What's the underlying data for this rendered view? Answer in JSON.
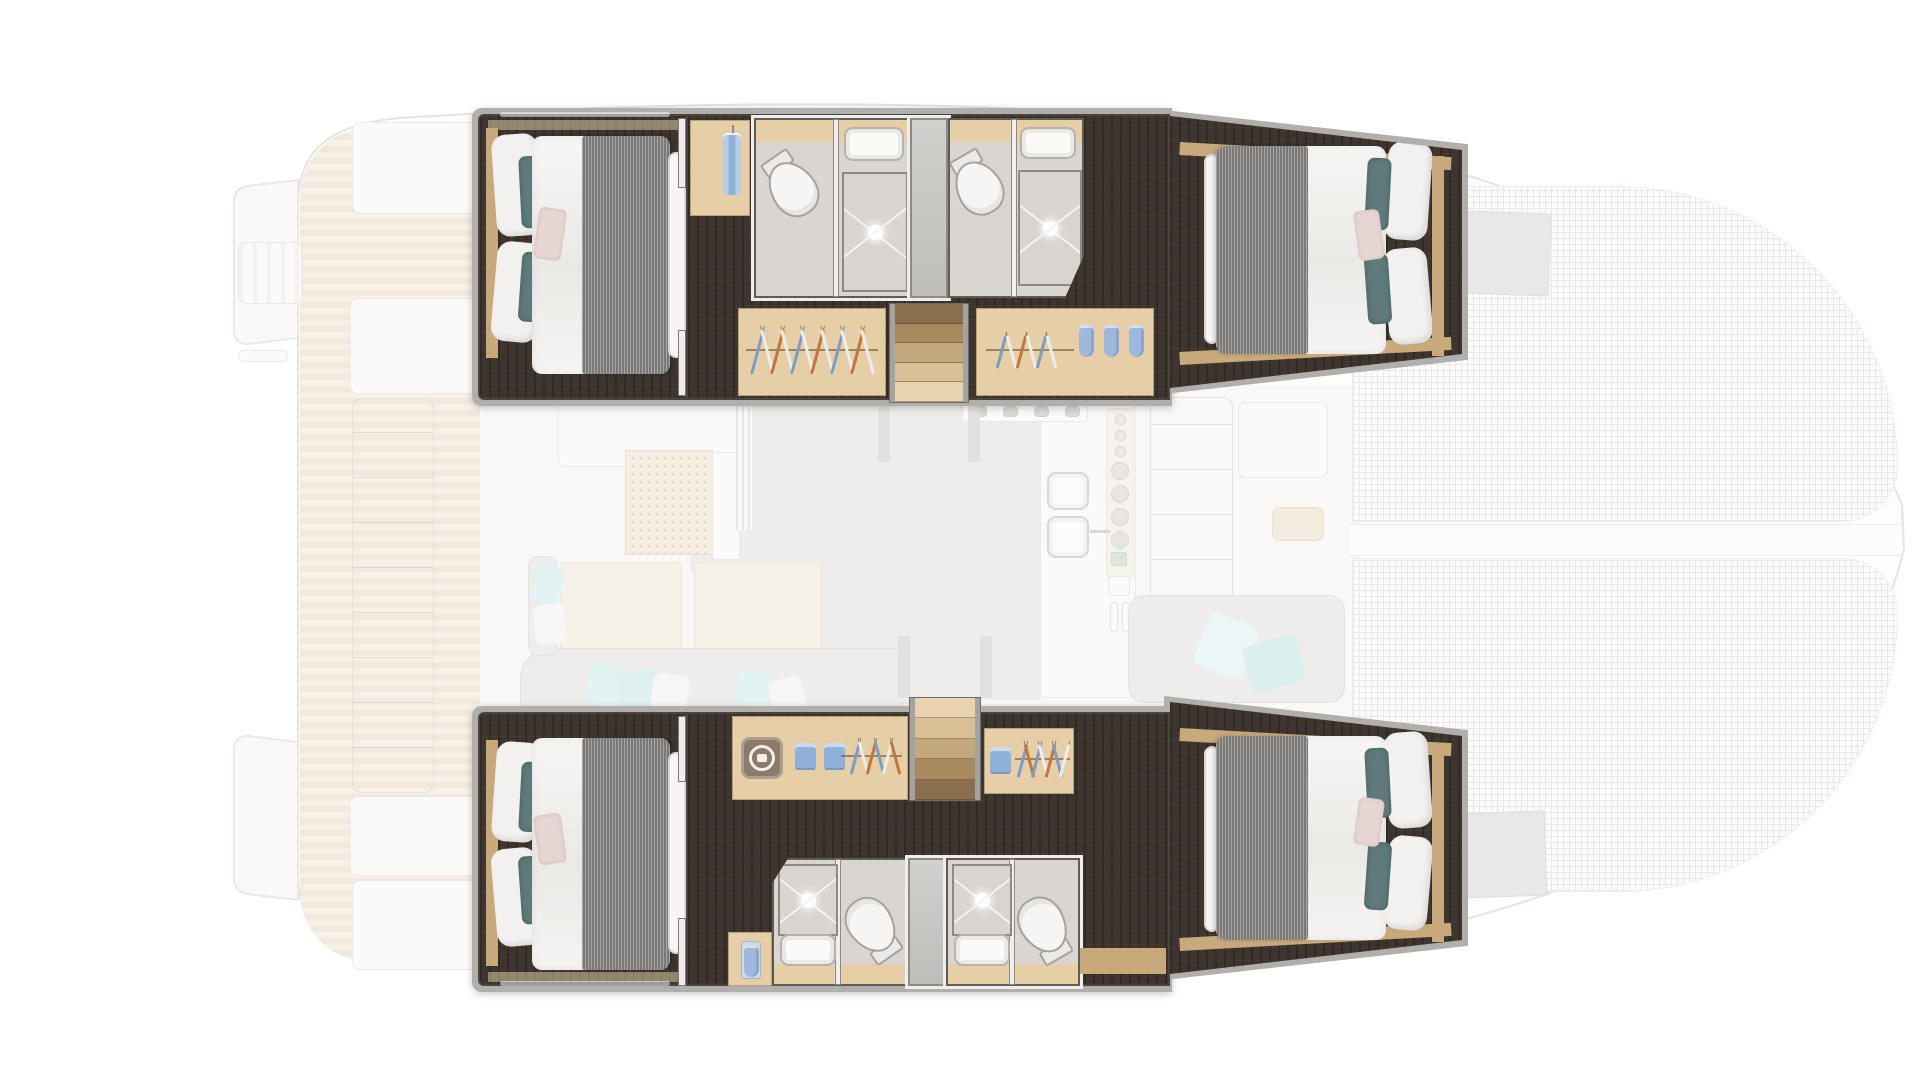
{
  "meta": {
    "description": "Top-down catamaran yacht floor plan; four highlighted hull cabins with en-suite shower rooms, wardrobes and companionway stairs; saloon, galley, cockpits, teak aft deck and bow trampoline shown ghosted/faded",
    "cabin_count": 4,
    "bathroom_count": 4,
    "stair_count": 2
  },
  "theme": {
    "dark_floor": "#3d352e",
    "band": "#b1afac",
    "wall_dark": "#4a443c",
    "wood": "#c8a97c",
    "wood_light": "#e6cfa6",
    "bath_floor": "#d9d6d2",
    "blanket": "#8f8d8a",
    "teal": "#5e7b79",
    "pink": "#e7d5d3",
    "ghost_gray": "#dedcd9",
    "teak_a": "#eee3cf",
    "teak_b": "#e2d4ba",
    "mesh_line": "#d7d3ce",
    "teal_light": "#c5e8e7"
  },
  "wardrobes": {
    "port_aft_hangers": [
      "#7d9cc4",
      "#ececea",
      "#c0763c",
      "#ececea",
      "#7d9cc4",
      "#ececea",
      "#c0763c",
      "#ececea",
      "#7d9cc4",
      "#ececea",
      "#c0763c",
      "#ececea"
    ],
    "port_fwd_hangers": [
      "#7d9cc4",
      "#ececea",
      "#c0763c",
      "#ececea",
      "#7d9cc4",
      "#ececea"
    ],
    "port_fwd_towels": [
      "#9db8dc",
      "#9db8dc",
      "#9db8dc"
    ],
    "stbd_aft_hangers": [
      "#7d9cc4",
      "#ececea",
      "#c0763c",
      "#7d9cc4",
      "#ececea",
      "#c0763c"
    ],
    "stbd_aft_shirts": [
      "#8fb0d8",
      "#8fb0d8"
    ],
    "stbd_fwd_hangers": [
      "#7d9cc4",
      "#c0763c",
      "#7d9cc4",
      "#ececea",
      "#c0763c",
      "#7d9cc4",
      "#ececea"
    ],
    "stbd_fwd_shirts": [
      "#8fb0d8"
    ],
    "closet_shirt_color": "#8fafd6",
    "closet_towel_color": "#9db8dc"
  },
  "stairs": {
    "port_treads": [
      "#8a6f4e",
      "#a98a60",
      "#c3a87e",
      "#d8bf96",
      "#e8d3ae"
    ],
    "stbd_treads": [
      "#e8d3ae",
      "#d8bf96",
      "#c3a87e",
      "#a98a60",
      "#8a6f4e"
    ]
  },
  "galley_ghost": {
    "burners": [
      "#b8b5b1",
      "#b8b5b1",
      "#b8b5b1",
      "#b8b5b1"
    ],
    "plates": [
      "#d2cfca",
      "#d2cfca",
      "#d2cfca",
      "#d2cfca"
    ],
    "small_plates": [
      "#d9d6d1",
      "#d9d6d1",
      "#d9d6d1"
    ]
  }
}
